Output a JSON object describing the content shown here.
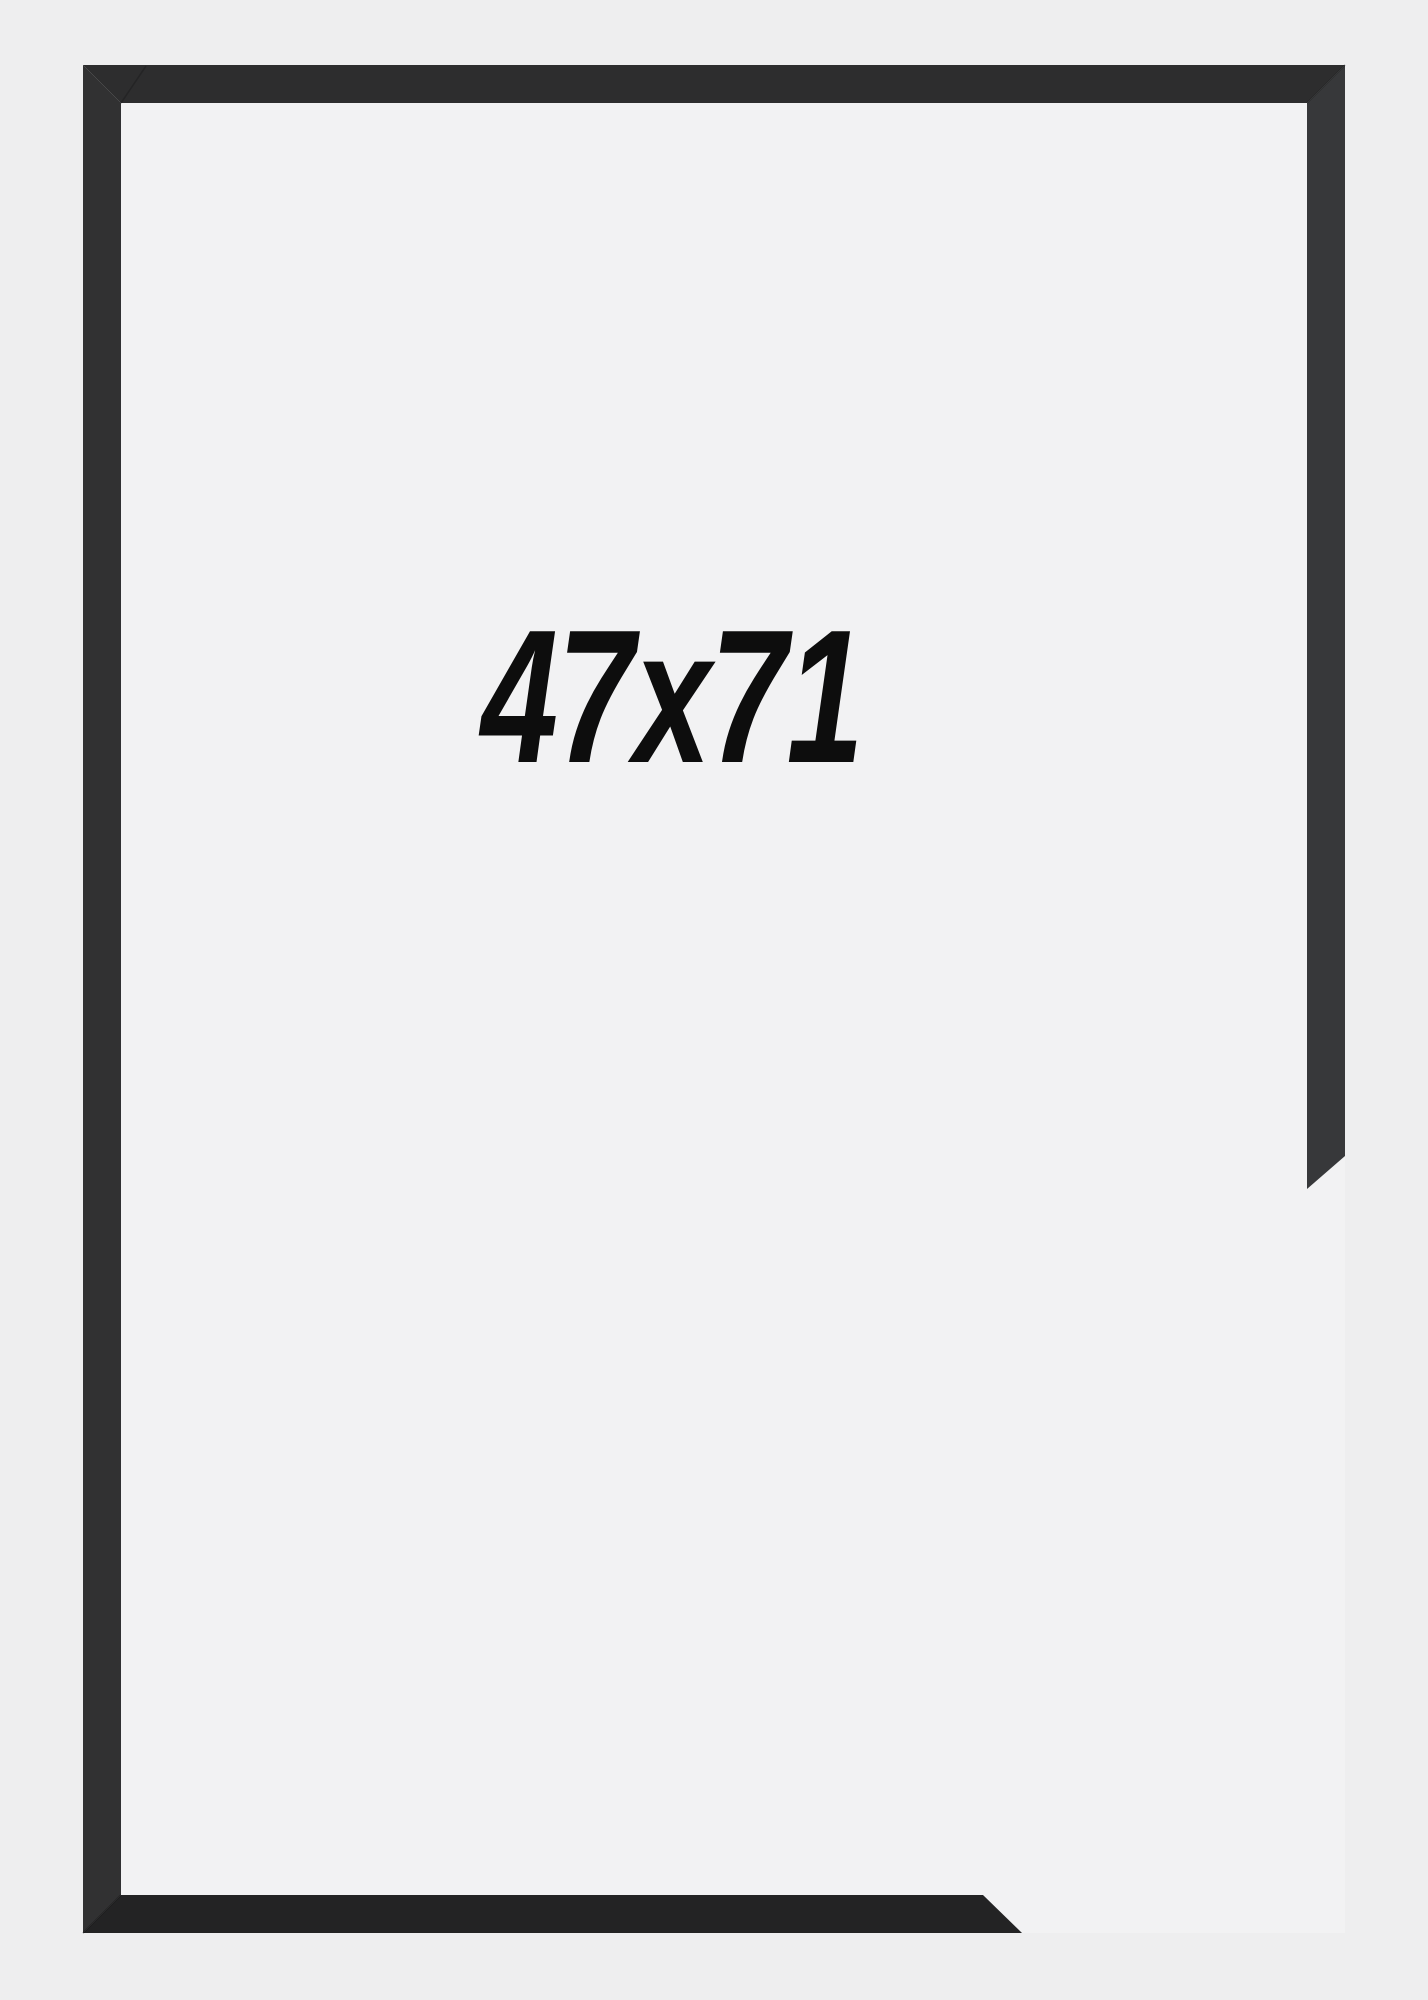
{
  "product": {
    "size_label": "47x71",
    "width_value": "47",
    "height_value": "71",
    "separator": "x"
  },
  "colors": {
    "background_outer": "#eeeeef",
    "background_inner": "#f2f2f3",
    "label_text": "#0d0d0d",
    "frame_top_bar": "#2d2d2e",
    "frame_left_bar": "#313132",
    "frame_right_bar": "#37383a",
    "frame_bottom_bar": "#232324",
    "closeup_face_light": "#58585a",
    "closeup_face_dark": "#27282a",
    "closeup_side_light": "#6b6b6f",
    "closeup_edge_dark": "#1c1c1e"
  }
}
